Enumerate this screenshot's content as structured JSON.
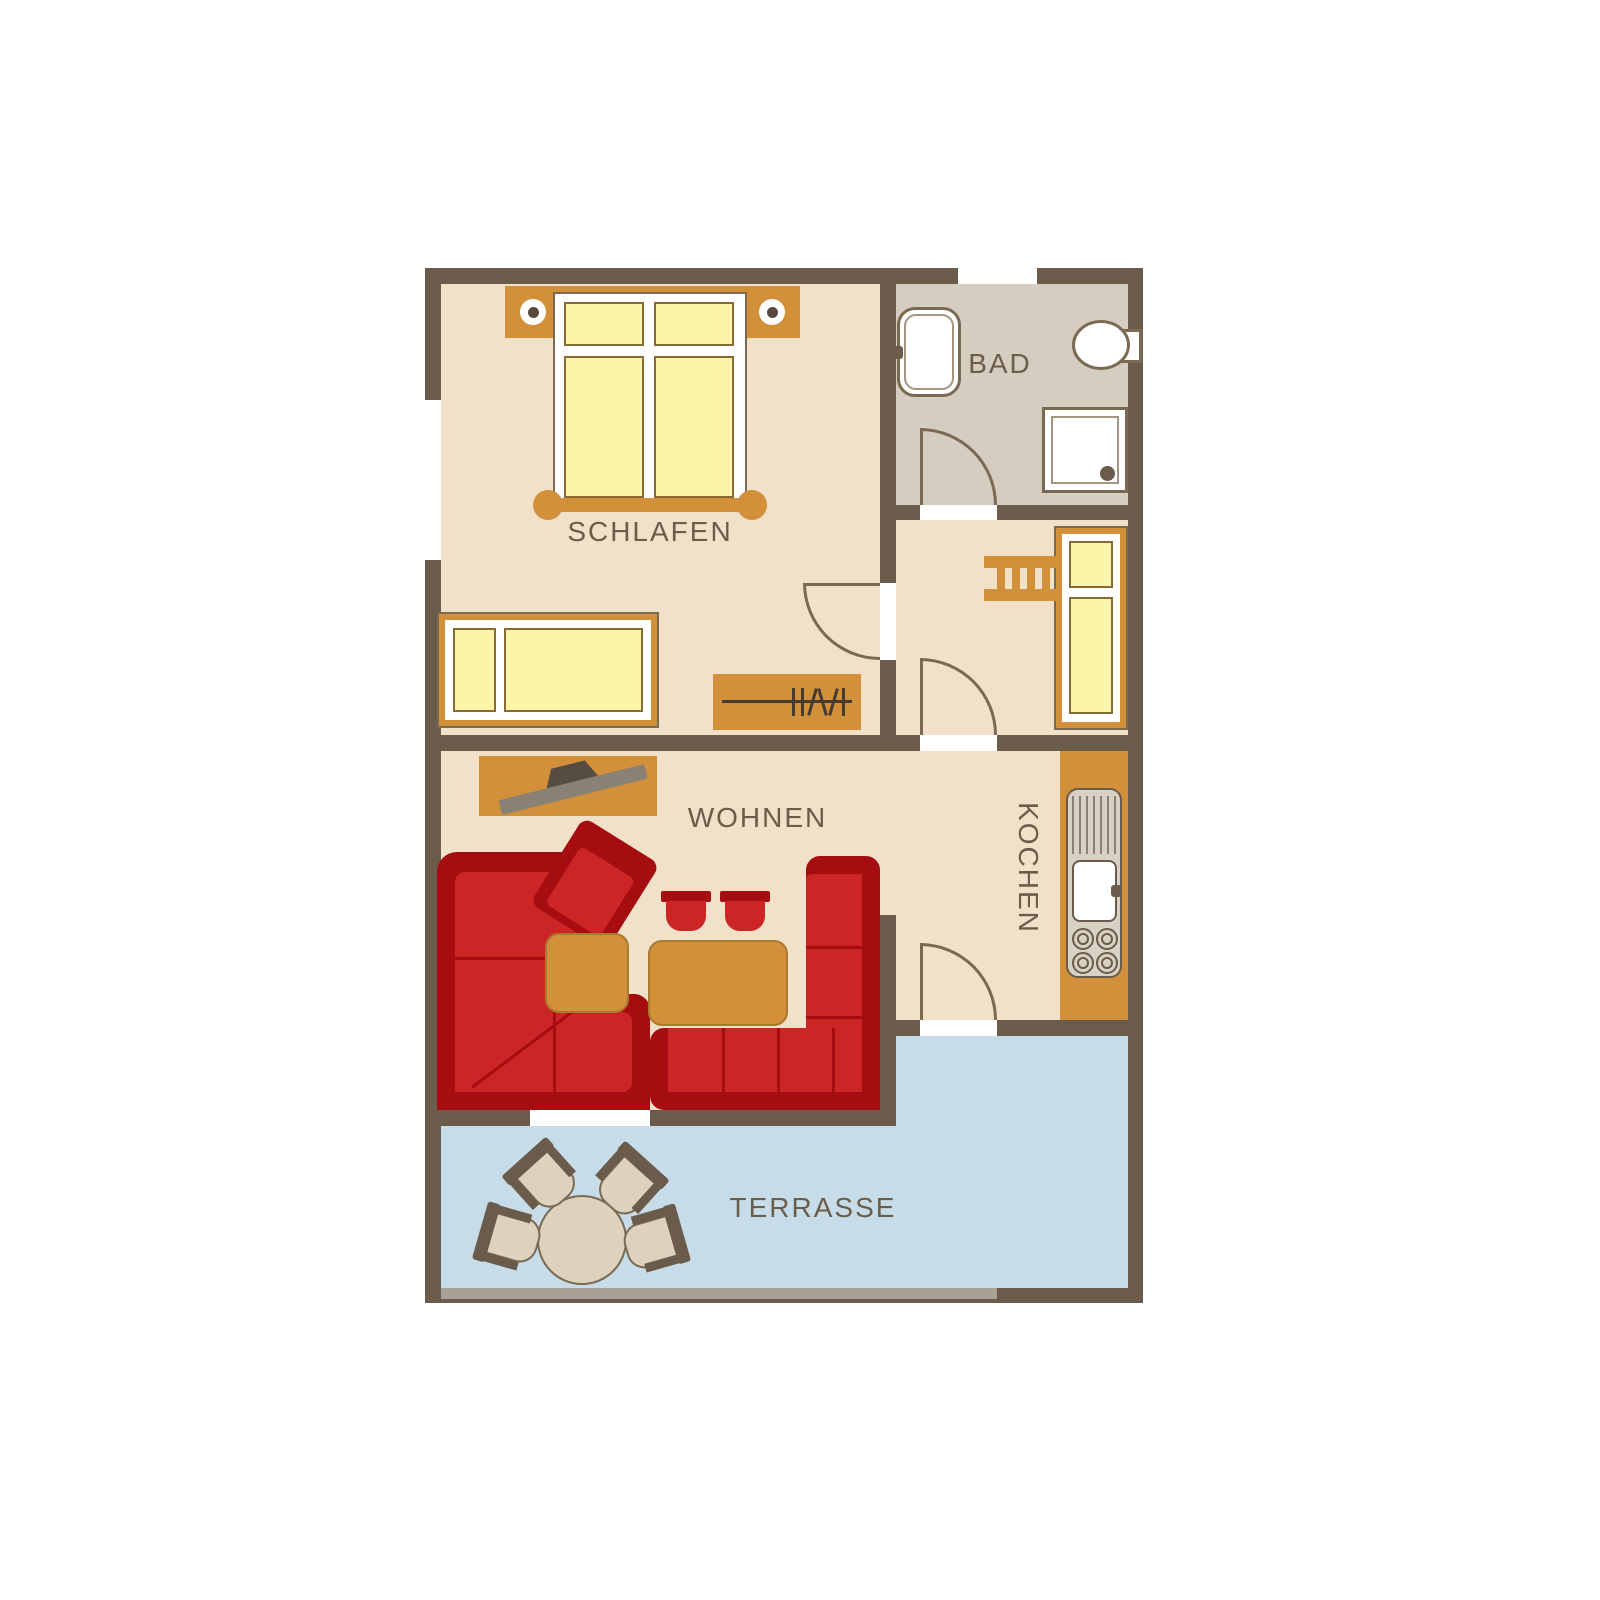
{
  "plan": {
    "title": "apartment-floor-plan",
    "rooms": {
      "schlafen": {
        "label": "SCHLAFEN"
      },
      "bad": {
        "label": "BAD"
      },
      "wohnen": {
        "label": "WOHNEN"
      },
      "kochen": {
        "label": "KOCHEN"
      },
      "terrasse": {
        "label": "TERRASSE"
      }
    },
    "colors": {
      "wall": "#6a5b4b",
      "floor": "#f0e1c8",
      "floor_bath": "#d6cdc1",
      "terrace": "#c6dde9",
      "accent_orange": "#d3903b",
      "bedding_yellow": "#fbf5aa",
      "bedding_border": "#8a6a33",
      "sofa_red": "#cc2526",
      "sofa_dark_red": "#a60d11",
      "line": "#7b6a52",
      "terrace_furniture": "#ddd2be",
      "step_gray": "#a9a193",
      "unit_gray": "#d8d2c5",
      "text": "#6b5d4b",
      "tv_gray": "#8a8175",
      "tv_dark": "#564c41",
      "table_border": "#a87a2e",
      "hanger": "#463b2f"
    }
  }
}
